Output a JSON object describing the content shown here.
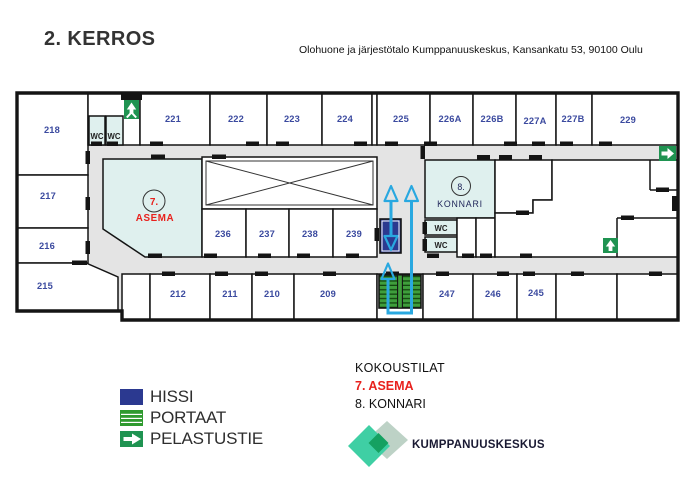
{
  "header": {
    "title": "2. KERROS",
    "subtitle": "Olohuone ja järjestötalo Kumppanuuskeskus, Kansankatu 53, 90100 Oulu"
  },
  "plan": {
    "left_rooms": [
      "218",
      "217",
      "216",
      "215"
    ],
    "top_rooms": [
      "221",
      "222",
      "223",
      "224",
      "225",
      "226A",
      "226B",
      "227A",
      "227B",
      "229"
    ],
    "mid_rooms": [
      "236",
      "237",
      "238",
      "239"
    ],
    "bottom_rooms": [
      "212",
      "211",
      "210",
      "209",
      "247",
      "246",
      "245"
    ],
    "wc_label": "WC",
    "room7": {
      "number": "7.",
      "name": "ASEMA"
    },
    "room8": {
      "number": "8.",
      "name": "KONNARI"
    }
  },
  "legend": {
    "items": [
      {
        "label": "HISSI"
      },
      {
        "label": "PORTAAT"
      },
      {
        "label": "PELASTUSTIE"
      }
    ]
  },
  "meeting_rooms": {
    "title": "KOKOUSTILAT",
    "items": [
      {
        "label": "7. ASEMA",
        "highlight": true
      },
      {
        "label": "8. KONNARI",
        "highlight": false
      }
    ]
  },
  "logo": {
    "text": "KUMPPANUUSKESKUS"
  },
  "colors": {
    "accent_red": "#e8211d",
    "room_number_blue": "#3b4a9f",
    "escape_cyan": "#29a8e0",
    "elevator_navy": "#2b3990",
    "stairs_green": "#3f9e3c",
    "exit_green": "#1f9351",
    "special_room_teal": "#dff0ee",
    "corridor_gray": "#e4e4e4",
    "wall_black": "#141414",
    "logo_teal": "#3fcfa4",
    "logo_sage": "#bdd2c6",
    "logo_green": "#15a161",
    "logo_text_navy": "#191932"
  }
}
